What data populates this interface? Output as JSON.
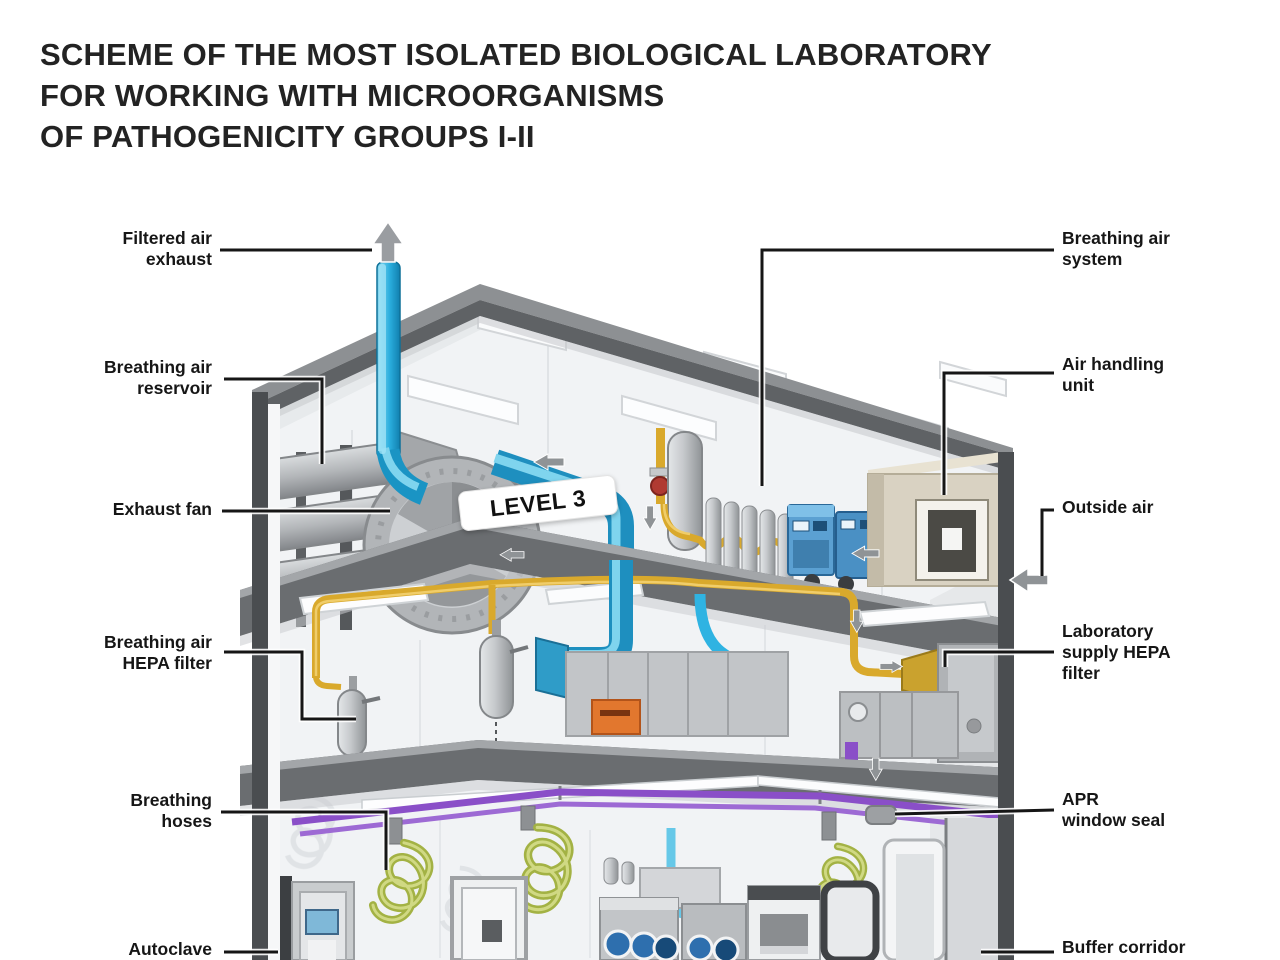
{
  "title": {
    "line1": "SCHEME OF THE MOST ISOLATED BIOLOGICAL LABORATORY",
    "line2": "FOR WORKING WITH MICROORGANISMS",
    "line3": "OF PATHOGENICITY GROUPS I-II"
  },
  "badge": {
    "text": "LEVEL 3"
  },
  "labels": {
    "left": [
      {
        "id": "filtered-air-exhaust",
        "line1": "Filtered air",
        "line2": "exhaust"
      },
      {
        "id": "breathing-air-reservoir",
        "line1": "Breathing air",
        "line2": "reservoir"
      },
      {
        "id": "exhaust-fan",
        "line1": "Exhaust fan"
      },
      {
        "id": "breathing-air-hepa-filter",
        "line1": "Breathing air",
        "line2": "HEPA filter"
      },
      {
        "id": "breathing-hoses",
        "line1": "Breathing",
        "line2": "hoses"
      },
      {
        "id": "autoclave",
        "line1": "Autoclave"
      }
    ],
    "right": [
      {
        "id": "breathing-air-system",
        "line1": "Breathing air",
        "line2": "system"
      },
      {
        "id": "air-handling-unit",
        "line1": "Air handling",
        "line2": "unit"
      },
      {
        "id": "outside-air",
        "line1": "Outside air"
      },
      {
        "id": "laboratory-supply-hepa-filter",
        "line1": "Laboratory",
        "line2": "supply HEPA",
        "line3": "filter"
      },
      {
        "id": "apr-window-seal",
        "line1": "APR",
        "line2": "window seal"
      },
      {
        "id": "buffer-corridor",
        "line1": "Buffer corridor"
      }
    ]
  },
  "colors": {
    "exhaust_air_blue": "#2aaede",
    "supply_air_yellow": "#d9a92c",
    "breathing_line_purple": "#8a4fc8",
    "breathing_hose_green": "#a3b244",
    "structure_gray": "#8d9093",
    "callout_line": "#161616"
  }
}
